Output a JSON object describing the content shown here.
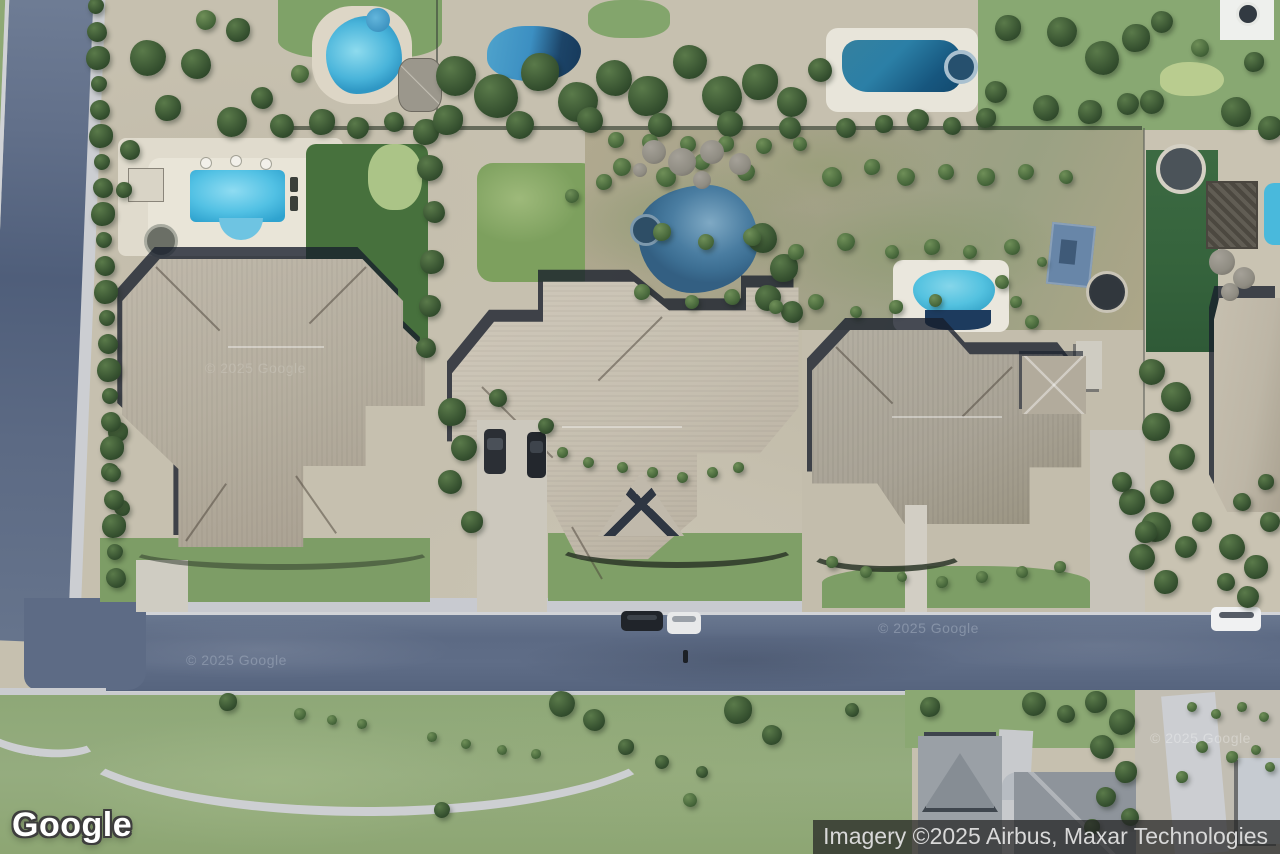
{
  "map": {
    "view_type": "satellite-imagery",
    "watermarks": [
      {
        "text": "© 2025 Google"
      },
      {
        "text": "© 2025 Google"
      },
      {
        "text": "© 2025 Google"
      },
      {
        "text": "© 2025 Google"
      }
    ]
  },
  "branding": {
    "logo_text": "Google"
  },
  "attribution": {
    "text": "Imagery ©2025 Airbus, Maxar Technologies"
  },
  "colors": {
    "pool_cyan": "#52c1e4",
    "pool_steel_blue": "#4a7da1",
    "road_asphalt": "#5f6d87",
    "lawn_green": "#7da05e",
    "ground_tan": "#c6c0af",
    "attribution_bg": "rgba(34,34,34,0.72)",
    "attribution_text": "#d8d8d8"
  }
}
